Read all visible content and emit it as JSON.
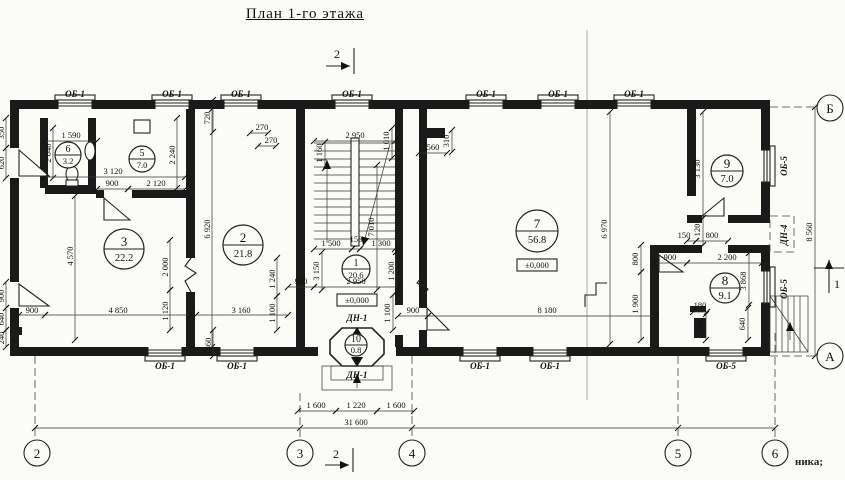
{
  "title": "План 1-го этажа",
  "footer_note": "ника;",
  "section_marks": {
    "s1": "1",
    "s2": "2"
  },
  "axes": {
    "a2": "2",
    "a3": "3",
    "a4": "4",
    "a5": "5",
    "a6": "6",
    "aA": "А",
    "aB": "Б"
  },
  "marks": {
    "ob1": "ОБ-1",
    "ob5": "ОБ-5",
    "dn1": "ДН-1",
    "dn4": "ДН-4",
    "level": "±0,000"
  },
  "rooms": {
    "r1": {
      "num": "1",
      "area": "20.6"
    },
    "r2": {
      "num": "2",
      "area": "21.8"
    },
    "r3": {
      "num": "3",
      "area": "22.2"
    },
    "r5": {
      "num": "5",
      "area": "7.0"
    },
    "r6": {
      "num": "6",
      "area": "3.2"
    },
    "r7": {
      "num": "7",
      "area": "56.8"
    },
    "r8": {
      "num": "8",
      "area": "9.1"
    },
    "r9": {
      "num": "9",
      "area": "7.0"
    },
    "r10": {
      "num": "10",
      "area": "0.8"
    }
  },
  "dims": {
    "d1590": "1 590",
    "d2040": "2 040",
    "d3120": "3 120",
    "d900": "900",
    "d2120": "2 120",
    "d2240": "2 240",
    "d720": "720",
    "d270": "270",
    "d350": "350",
    "d620": "620",
    "d640": "640",
    "d240": "240",
    "d4570": "4 570",
    "d4850": "4 850",
    "d2000": "2 000",
    "d1120": "1 120",
    "d6920": "6 920",
    "d3160": "3 160",
    "d1240": "1 240",
    "d1100": "1 100",
    "d860": "860",
    "d2950": "2 950",
    "d1160": "1 160",
    "d1010": "1 010",
    "d7010": "7 010",
    "d1500": "1 500",
    "d150": "150",
    "d1300": "1 300",
    "d3150": "3 150",
    "d1200": "1 200",
    "d560": "560",
    "d310": "310",
    "d6970": "6 970",
    "d8180": "8 180",
    "d800": "800",
    "d1900": "1 900",
    "d3130": "3 130",
    "d120": "120",
    "d2200": "2 200",
    "d3868": "3 868",
    "d180": "180",
    "d8560": "8 560",
    "d1600": "1 600",
    "d1220": "1 220",
    "d31600": "31 600"
  }
}
